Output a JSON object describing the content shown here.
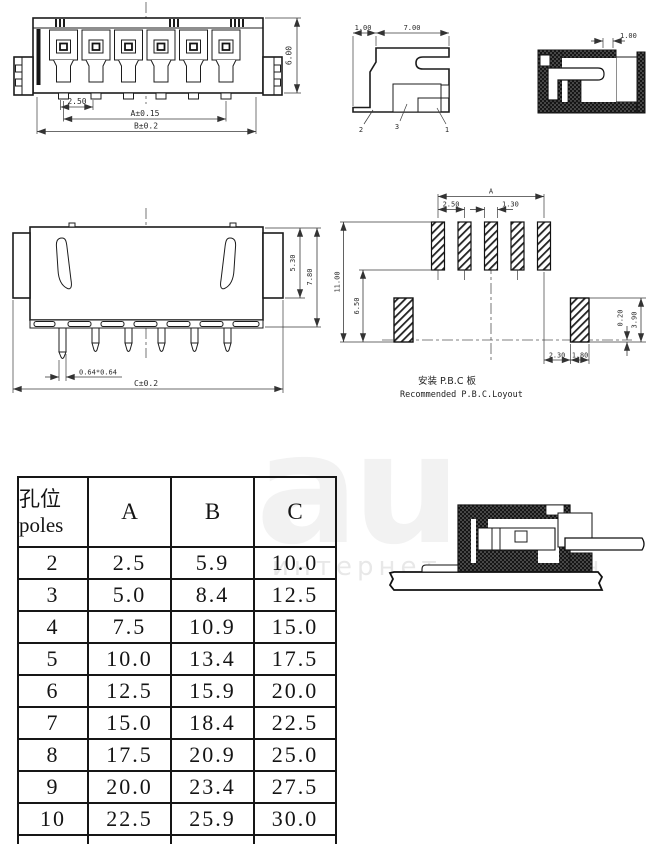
{
  "front_view": {
    "dim_pitch": "2.50",
    "dim_a": "A±0.15",
    "dim_b": "B±0.2",
    "dim_height": "6.00"
  },
  "side_view": {
    "dim_offset": "1.00",
    "dim_depth": "7.00",
    "leader_2": "2",
    "leader_3": "3",
    "leader_1": "1",
    "dim_wall": "1.00"
  },
  "rear_view": {
    "dim_slot_depth": "5.30",
    "dim_body_height": "7.80",
    "dim_pin_size": "0.64*0.64",
    "dim_c": "C±0.2"
  },
  "pcb_layout": {
    "dim_span_a": "A",
    "dim_pad_pitch": "2.50",
    "dim_pad_width": "1.30",
    "dim_total_height": "11.00",
    "dim_pad_gap": "6.50",
    "dim_2_30": "2.30",
    "dim_1_80": "1.80",
    "dim_0_20": "0.20",
    "dim_3_90": "3.90",
    "caption_zh": "安装 P.B.C 板",
    "caption_en": "Recommended P.B.C.Loyout"
  },
  "spec_table": {
    "header": {
      "poles_zh": "孔位",
      "poles_en": "poles",
      "col_a": "A",
      "col_b": "B",
      "col_c": "C"
    },
    "rows": [
      {
        "poles": "2",
        "a": "2.5",
        "b": "5.9",
        "c": "10.0"
      },
      {
        "poles": "3",
        "a": "5.0",
        "b": "8.4",
        "c": "12.5"
      },
      {
        "poles": "4",
        "a": "7.5",
        "b": "10.9",
        "c": "15.0"
      },
      {
        "poles": "5",
        "a": "10.0",
        "b": "13.4",
        "c": "17.5"
      },
      {
        "poles": "6",
        "a": "12.5",
        "b": "15.9",
        "c": "20.0"
      },
      {
        "poles": "7",
        "a": "15.0",
        "b": "18.4",
        "c": "22.5"
      },
      {
        "poles": "8",
        "a": "17.5",
        "b": "20.9",
        "c": "25.0"
      },
      {
        "poles": "9",
        "a": "20.0",
        "b": "23.4",
        "c": "27.5"
      },
      {
        "poles": "10",
        "a": "22.5",
        "b": "25.9",
        "c": "30.0"
      }
    ]
  },
  "watermark": {
    "logo": "au",
    "caption": "интернет аукцион"
  },
  "colors": {
    "line": "#1a1a1a",
    "dim_line": "#3a3a3a",
    "background": "#ffffff"
  }
}
